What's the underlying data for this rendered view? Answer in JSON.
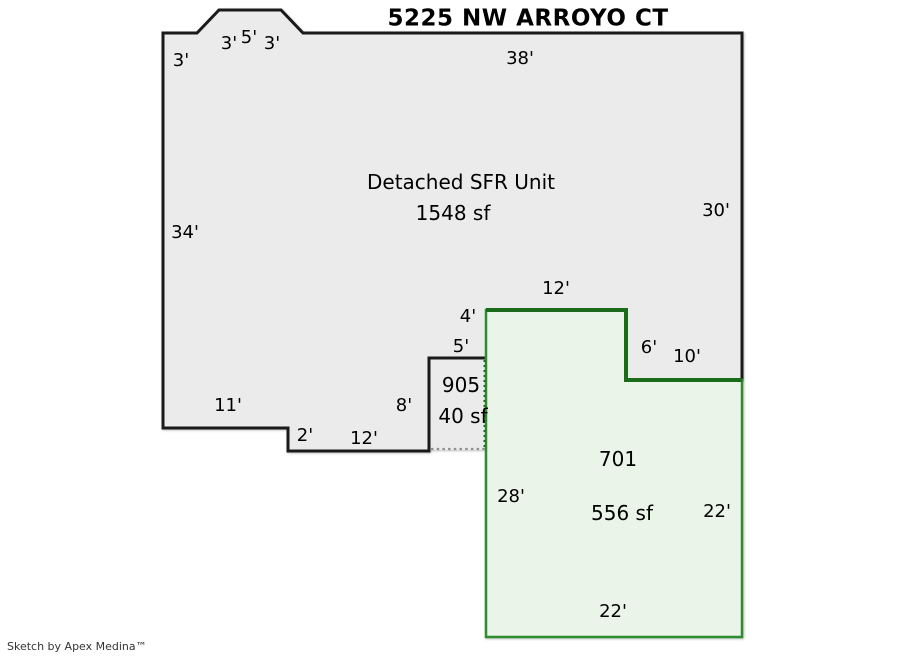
{
  "title": "5225 NW ARROYO CT",
  "credit": "Sketch by Apex Medina™",
  "colors": {
    "background": "#ffffff",
    "outline": "#1a1a1a",
    "unit_fill": "#ebebeb",
    "adu_fill": "#eaf4e8",
    "adu_outline": "#2e8b2e",
    "adu_outline_dark": "#1a6b1a",
    "porch_dotted_line": "#909090"
  },
  "main_unit": {
    "name": "Detached SFR Unit",
    "area": "1548 sf",
    "dims": {
      "left_top": "3'",
      "bump_left": "3'",
      "bump_top": "5'",
      "bump_right": "3'",
      "top": "38'",
      "left": "34'",
      "right": "30'",
      "bottom_left": "11'",
      "step_down": "2'",
      "bottom_mid": "12'",
      "notch_side": "8'",
      "inset_left": "4'",
      "inset_right": "6'",
      "bottom_right": "10'"
    }
  },
  "porch": {
    "id": "905",
    "area": "40 sf",
    "dims": {
      "top": "5'"
    }
  },
  "adu": {
    "id": "701",
    "area": "556 sf",
    "dims": {
      "top": "12'",
      "left": "28'",
      "right": "22'",
      "bottom": "22'"
    }
  }
}
